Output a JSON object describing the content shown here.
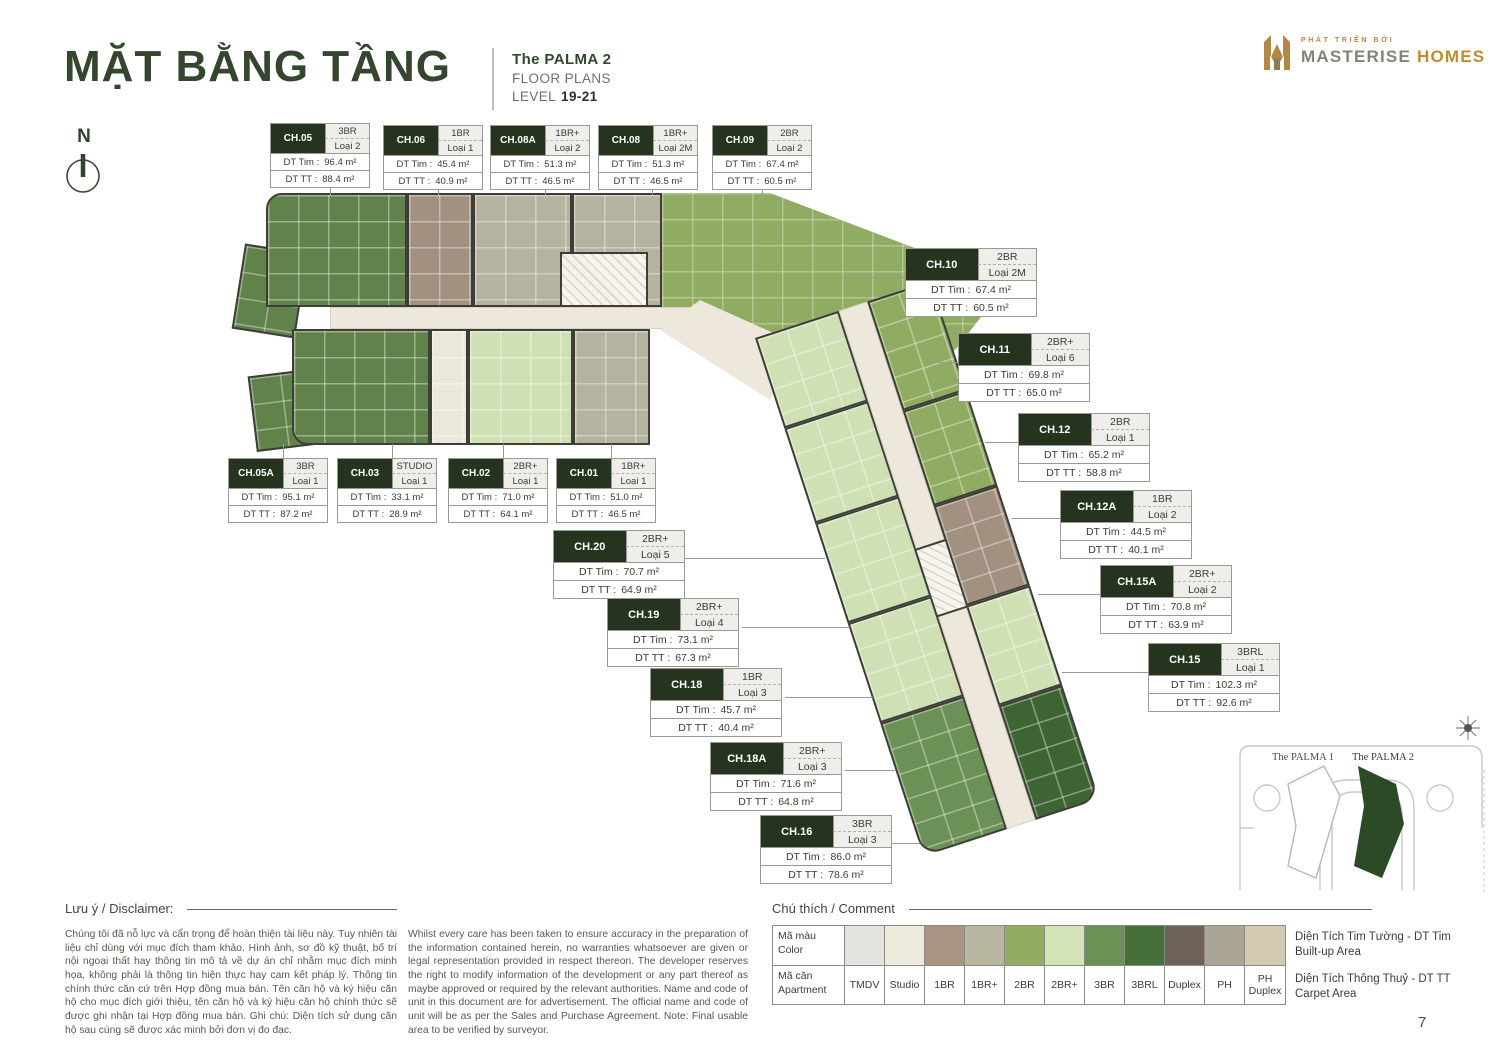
{
  "header": {
    "title": "MẶT BẰNG TẦNG",
    "project": "The PALMA 2",
    "subtitle": "FLOOR PLANS",
    "level_label": "LEVEL",
    "level_value": "19-21"
  },
  "logo": {
    "tagline": "PHÁT TRIỂN BỞI",
    "brand_primary": "MASTERISE",
    "brand_secondary": "HOMES"
  },
  "compass": {
    "label": "N"
  },
  "labels": {
    "dt_tim": "DT Tim :",
    "dt_tt": "DT TT :"
  },
  "colors": {
    "brand_green": "#35462f",
    "gold": "#b08a45",
    "label_dark": "#26341f"
  },
  "plan": {
    "units": [
      {
        "code": "CH.05",
        "type": "3BR",
        "loai": "Loại 2",
        "dt_tim": "96.4 m²",
        "dt_tt": "88.4 m²"
      },
      {
        "code": "CH.06",
        "type": "1BR",
        "loai": "Loại 1",
        "dt_tim": "45.4 m²",
        "dt_tt": "40.9 m²"
      },
      {
        "code": "CH.08A",
        "type": "1BR+",
        "loai": "Loại 2",
        "dt_tim": "51.3 m²",
        "dt_tt": "46.5 m²"
      },
      {
        "code": "CH.08",
        "type": "1BR+",
        "loai": "Loại 2M",
        "dt_tim": "51.3 m²",
        "dt_tt": "46.5 m²"
      },
      {
        "code": "CH.09",
        "type": "2BR",
        "loai": "Loại 2",
        "dt_tim": "67.4 m²",
        "dt_tt": "60.5 m²"
      },
      {
        "code": "CH.10",
        "type": "2BR",
        "loai": "Loại 2M",
        "dt_tim": "67.4 m²",
        "dt_tt": "60.5 m²"
      },
      {
        "code": "CH.11",
        "type": "2BR+",
        "loai": "Loại 6",
        "dt_tim": "69.8 m²",
        "dt_tt": "65.0 m²"
      },
      {
        "code": "CH.12",
        "type": "2BR",
        "loai": "Loại 1",
        "dt_tim": "65.2 m²",
        "dt_tt": "58.8 m²"
      },
      {
        "code": "CH.12A",
        "type": "1BR",
        "loai": "Loại 2",
        "dt_tim": "44.5 m²",
        "dt_tt": "40.1 m²"
      },
      {
        "code": "CH.15A",
        "type": "2BR+",
        "loai": "Loại 2",
        "dt_tim": "70.8 m²",
        "dt_tt": "63.9 m²"
      },
      {
        "code": "CH.15",
        "type": "3BRL",
        "loai": "Loại 1",
        "dt_tim": "102.3 m²",
        "dt_tt": "92.6 m²"
      },
      {
        "code": "CH.05A",
        "type": "3BR",
        "loai": "Loại 1",
        "dt_tim": "95.1 m²",
        "dt_tt": "87.2 m²"
      },
      {
        "code": "CH.03",
        "type": "STUDIO",
        "loai": "Loại 1",
        "dt_tim": "33.1 m²",
        "dt_tt": "28.9 m²"
      },
      {
        "code": "CH.02",
        "type": "2BR+",
        "loai": "Loại 1",
        "dt_tim": "71.0 m²",
        "dt_tt": "64.1 m²"
      },
      {
        "code": "CH.01",
        "type": "1BR+",
        "loai": "Loại 1",
        "dt_tim": "51.0 m²",
        "dt_tt": "46.5 m²"
      },
      {
        "code": "CH.20",
        "type": "2BR+",
        "loai": "Loại 5",
        "dt_tim": "70.7 m²",
        "dt_tt": "64.9 m²"
      },
      {
        "code": "CH.19",
        "type": "2BR+",
        "loai": "Loại 4",
        "dt_tim": "73.1 m²",
        "dt_tt": "67.3 m²"
      },
      {
        "code": "CH.18",
        "type": "1BR",
        "loai": "Loại 3",
        "dt_tim": "45.7 m²",
        "dt_tt": "40.4 m²"
      },
      {
        "code": "CH.18A",
        "type": "2BR+",
        "loai": "Loại 3",
        "dt_tim": "71.6 m²",
        "dt_tt": "64.8 m²"
      },
      {
        "code": "CH.16",
        "type": "3BR",
        "loai": "Loại 3",
        "dt_tim": "86.0 m²",
        "dt_tt": "78.6 m²"
      }
    ]
  },
  "legend": {
    "title": "Chú thích / Comment",
    "row1_header_l1": "Mã màu",
    "row1_header_l2": "Color",
    "row2_header_l1": "Mã căn",
    "row2_header_l2": "Apartment",
    "items": [
      {
        "label": "TMDV",
        "color": "#e2e5df"
      },
      {
        "label": "Studio",
        "color": "#eeeadc"
      },
      {
        "label": "1BR",
        "color": "#a99483"
      },
      {
        "label": "1BR+",
        "color": "#b8b5a0"
      },
      {
        "label": "2BR",
        "color": "#90ad62"
      },
      {
        "label": "2BR+",
        "color": "#d3e3b8"
      },
      {
        "label": "3BR",
        "color": "#6c9157"
      },
      {
        "label": "3BRL",
        "color": "#46703a"
      },
      {
        "label": "Duplex",
        "color": "#6f625b"
      },
      {
        "label": "PH",
        "color": "#aba596"
      },
      {
        "label": "PH Duplex",
        "color": "#d4cab2"
      }
    ],
    "notes": [
      {
        "l1": "Diện Tích Tim Tường - DT Tim",
        "l2": "Built-up Area"
      },
      {
        "l1": "Diện Tích Thông Thuỷ - DT TT",
        "l2": "Carpet Area"
      }
    ]
  },
  "disclaimer": {
    "title": "Lưu ý / Disclaimer:",
    "vi": "Chúng tôi đã nỗ lực và cẩn trọng để hoàn thiện tài liệu này. Tuy nhiên tài liệu chỉ dùng với mục đích tham khảo. Hình ảnh, sơ đồ kỹ thuật, bố trí nội ngoại thất hay thông tin mô tả về dự án chỉ nhằm mục đích minh họa, không phải là thông tin hiện thực hay cam kết pháp lý. Thông tin chính thức căn cứ trên Hợp đồng mua bán. Tên căn hộ và ký hiệu căn hộ cho mục đích giới thiệu, tên căn hộ và ký hiệu căn hộ chính thức sẽ được ghi nhận tại Hợp đồng mua bán. Ghi chú: Diện tích sử dụng căn hộ sau cùng sẽ được xác minh bởi đơn vị đo đạc.",
    "en": "Whilst every care has been taken to ensure accuracy in the preparation of the information contained herein, no warranties whatsoever are given or legal representation provided in respect thereon. The developer reserves the right to modify information of the development or any part thereof as maybe approved or required by the relevant authorities. Name and code of unit in this document are for advertisement. The official name and code of unit will be as per the Sales and Purchase Agreement. Note: Final usable area to be verified by surveyor."
  },
  "sitemap": {
    "palma1": "The PALMA 1",
    "palma2": "The PALMA 2"
  },
  "page_number": "7"
}
